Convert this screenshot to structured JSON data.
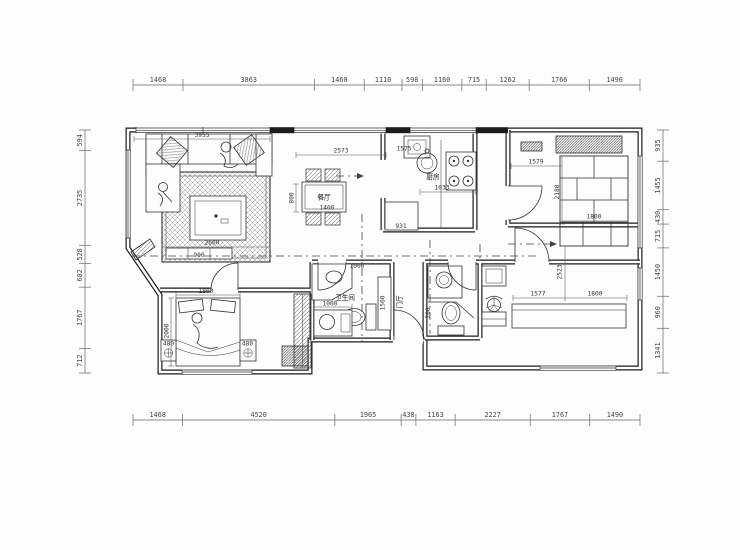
{
  "drawing": {
    "type": "apartment floor plan",
    "dims": {
      "top": [
        "1468",
        "3863",
        "1460",
        "1110",
        "598",
        "1160",
        "715",
        "1262",
        "1766",
        "1490"
      ],
      "bottom": [
        "1468",
        "4520",
        "1965",
        "438",
        "1163",
        "2227",
        "1767",
        "1490"
      ],
      "left": [
        "594",
        "2735",
        "528",
        "682",
        "1767",
        "712"
      ],
      "right": [
        "935",
        "1455",
        "430",
        "715",
        "1450",
        "960",
        "1341"
      ]
    },
    "rooms": {
      "kitchen": "厨房",
      "dining": "餐厅",
      "bath": "卫生间",
      "foyer": "门厅"
    },
    "labels": {
      "living_width": "3955",
      "balcony": "2573",
      "rug_width": "2600",
      "tv_cabinet": "900",
      "dining_depth": "800",
      "dining_width": "1400",
      "kitchen_top": "1575",
      "kitchen_run": "1033",
      "kitchen_duct": "931",
      "closet_left": "1579",
      "closet_depth": "2180",
      "closet_shelf": "1800",
      "bed2_depth": "2523",
      "bed2_w1": "1577",
      "bed2_w2": "1800",
      "bath_top": "1000",
      "bath_vanity": "1000",
      "bath_cabinet": "1560",
      "bath2_side": "200",
      "bed_width": "1800",
      "bed_length": "2000",
      "nightstand_l": "480",
      "nightstand_r": "480"
    },
    "colors": {
      "line": "#2a2a2a",
      "dim": "#666666",
      "bg": "#fdfdfd"
    }
  }
}
